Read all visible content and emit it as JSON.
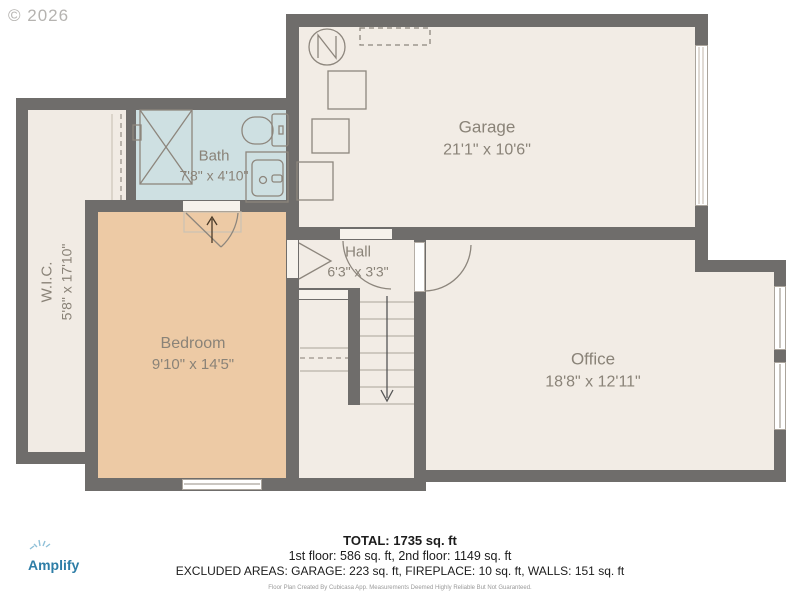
{
  "watermark": "© 2026",
  "rooms": [
    {
      "name": "Garage",
      "dims": "21'1\" x 10'6\""
    },
    {
      "name": "Bath",
      "dims": "7'8\" x 4'10\""
    },
    {
      "name": "Hall",
      "dims": "6'3\" x 3'3\""
    },
    {
      "name": "W.I.C.",
      "dims": "5'8\" x 17'10\""
    },
    {
      "name": "Bedroom",
      "dims": "9'10\" x 14'5\""
    },
    {
      "name": "Office",
      "dims": "18'8\" x 12'11\""
    }
  ],
  "footer": {
    "total": "TOTAL: 1735 sq. ft",
    "floors": "1st floor: 586 sq. ft, 2nd floor: 1149 sq. ft",
    "excluded": "EXCLUDED AREAS: GARAGE: 223 sq. ft, FIREPLACE: 10 sq. ft, WALLS: 151 sq. ft",
    "disclaimer": "Floor Plan Created By Cubicasa App. Measurements Deemed Highly Reliable But Not Guaranteed."
  },
  "branding": {
    "logo": "Amplify"
  },
  "colors": {
    "wall": "#6f6d6b",
    "floor_cream": "#f2ece5",
    "floor_bath": "#cee0e2",
    "floor_bedroom": "#edcaa5",
    "fixture_stroke": "#8d867d",
    "label_text": "#8a8378",
    "logo_blue": "#2e7ea7"
  }
}
